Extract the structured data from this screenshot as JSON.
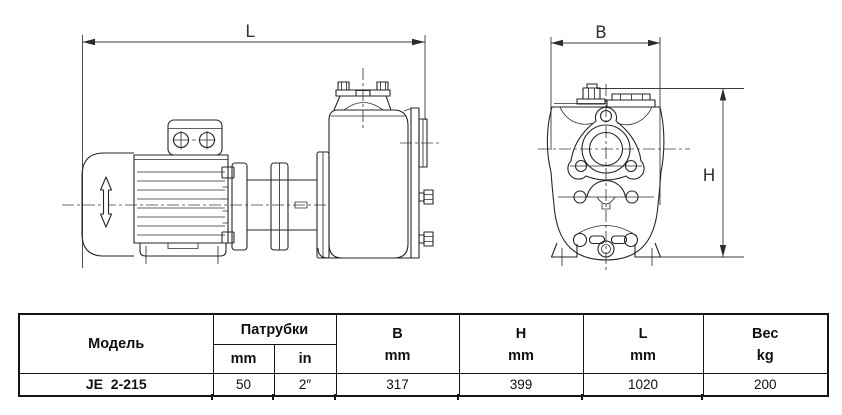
{
  "drawing": {
    "dim_length_label": "L",
    "dim_width_label": "B",
    "dim_height_label": "H"
  },
  "table": {
    "headers": {
      "model": "Модель",
      "ports": "Патрубки",
      "ports_mm": "mm",
      "ports_in": "in",
      "b": "B",
      "b_unit": "mm",
      "h": "H",
      "h_unit": "mm",
      "l": "L",
      "l_unit": "mm",
      "weight": "Вес",
      "weight_unit": "kg"
    },
    "rows": [
      {
        "model": "JE  2-215",
        "port_mm": "50",
        "port_in": "2″",
        "b_mm": "317",
        "h_mm": "399",
        "l_mm": "1020",
        "weight_kg": "200"
      }
    ]
  }
}
